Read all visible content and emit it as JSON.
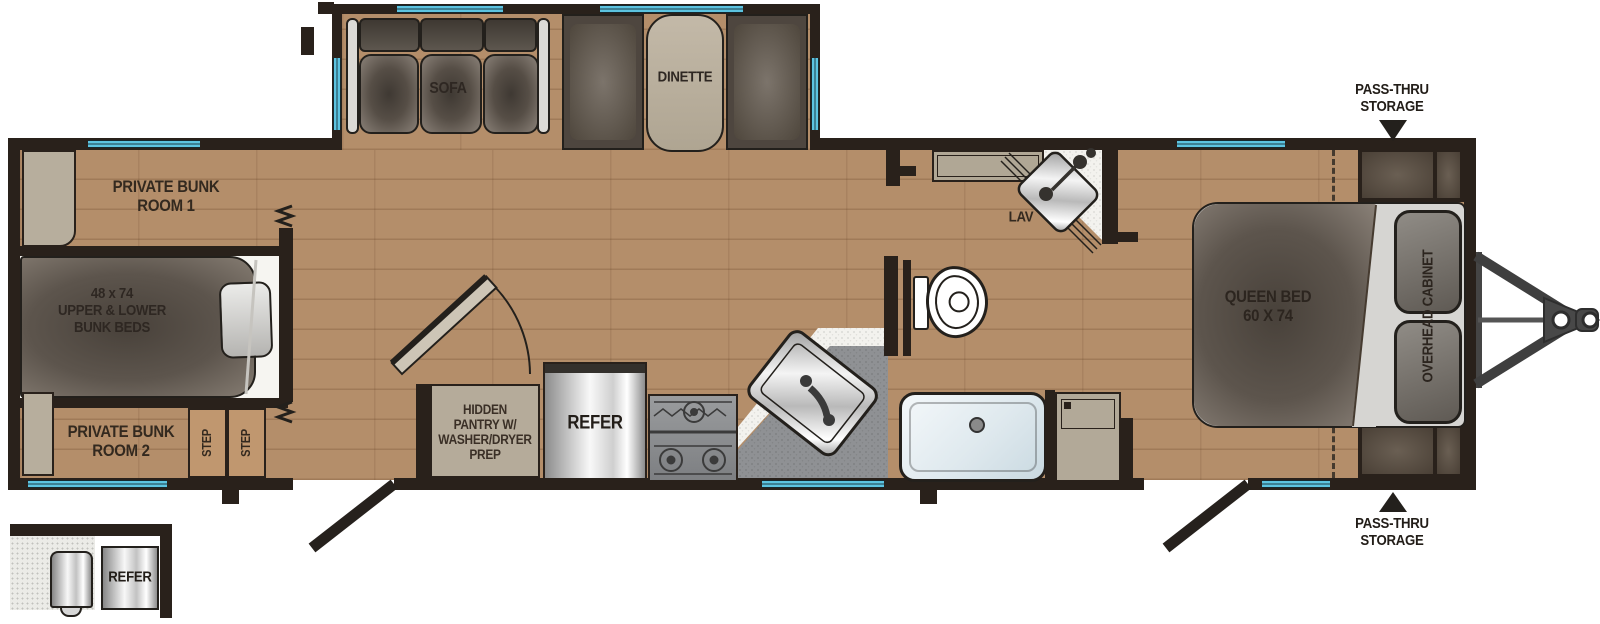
{
  "colors": {
    "wood_floor": "#b48e6a",
    "wall": "#29211b",
    "window_blue": "#5cc3e0",
    "counter_gray": "#8f9194",
    "cabinet_tan": "#b7ae9d",
    "upholstery_dark": "#564e46",
    "steel_silver": "#c8c8c8",
    "label_text": "#33291f"
  },
  "labels": {
    "bunk_room_1": "PRIVATE BUNK\nROOM 1",
    "bunk_beds": "48 x 74\nUPPER & LOWER\nBUNK BEDS",
    "bunk_room_2": "PRIVATE BUNK\nROOM 2",
    "step_1": "STEP",
    "step_2": "STEP",
    "sofa": "SOFA",
    "dinette": "DINETTE",
    "hidden_pantry": "HIDDEN\nPANTRY W/\nWASHER/DRYER\nPREP",
    "refer": "REFER",
    "lav": "LAV",
    "queen_bed": "QUEEN BED\n60 X 74",
    "overhead_cabinet": "OVERHEAD CABINET",
    "pass_thru_top": "PASS-THRU\nSTORAGE",
    "pass_thru_bottom": "PASS-THRU\nSTORAGE",
    "exterior_refer": "REFER"
  }
}
